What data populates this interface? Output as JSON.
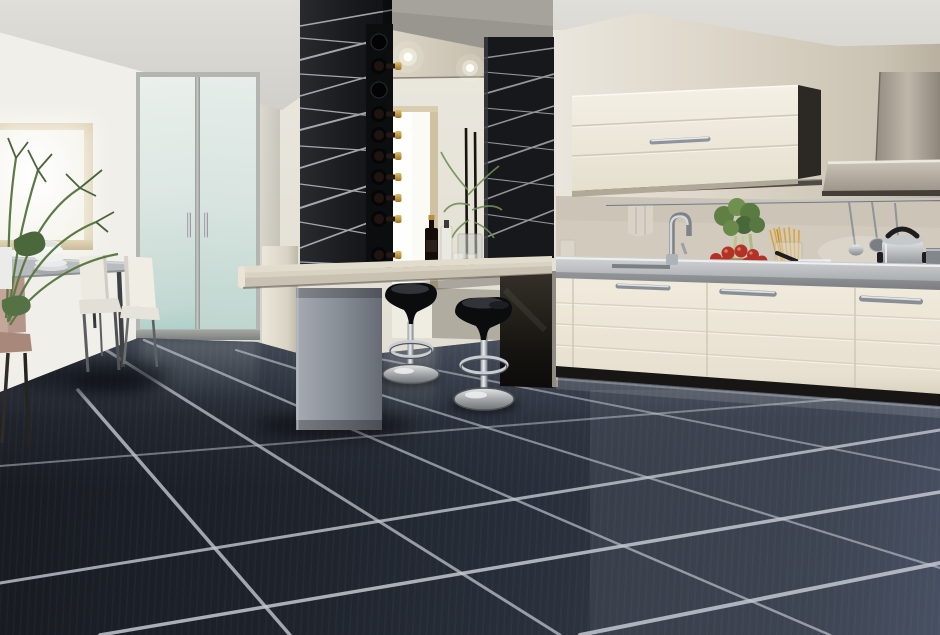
{
  "image": {
    "type": "photograph",
    "subject": "Modern open-plan kitchen interior with glossy dark diagonal floor tiles and silver grout",
    "width_px": 940,
    "height_px": 635
  },
  "palette": {
    "ceiling": "#d9d7d2",
    "left_wall": "#eeede7",
    "center_wall": "#e9e6dd",
    "right_wall_beige": "#d6cfc1",
    "floor_far": "#454c5a",
    "floor_near": "#14161c",
    "grout_line": "#c3c8d0",
    "panel_black": "#1b1c20",
    "panel_stripe": "#cfd3d8",
    "cabinet_cream": "#f0ebdf",
    "counter_steel": "#c3c6c7",
    "bar_counter": "#ddd7c8",
    "bar_pillar_gray": "#868c94",
    "stool_black": "#0b0c0e",
    "chrome": "#c9ced3",
    "door_glass": "#dde8e4",
    "door_glass_teal": "#bcd8d2",
    "window_glow": "#fbfbf7",
    "wood_frame": "#d8cbab",
    "plant_green": "#5d7c43",
    "wine_cap_gold": "#c9a24e",
    "tomato_red": "#b23228",
    "spaghetti_gold": "#d9a53f",
    "terracotta": "#b25c3c",
    "towel": "#d8d2c7",
    "chair_white": "#edeae2",
    "chair_salmon": "#b5968a",
    "table_gray": "#b9bcbe",
    "hood_steel": "#a89f93"
  },
  "objects": [
    {
      "name": "window-left",
      "label": "Daylight window with pale wood frame"
    },
    {
      "name": "houseplant",
      "label": "Leafy green houseplant in white vase"
    },
    {
      "name": "dining-table",
      "label": "Gray dining table"
    },
    {
      "name": "plate-stack",
      "label": "Stack of white bowls and plates"
    },
    {
      "name": "dining-chair-white",
      "label": "White dining chair",
      "count": 2
    },
    {
      "name": "dining-chair-salmon",
      "label": "Salmon dining chair",
      "count": 1
    },
    {
      "name": "frosted-double-doors",
      "label": "Frosted glass double doors with chrome pull handles"
    },
    {
      "name": "black-pillar",
      "label": "Black pillar with etched silver line pattern"
    },
    {
      "name": "wine-rack",
      "label": "Column wine rack",
      "bottle_count": 8,
      "empty_slots": 2
    },
    {
      "name": "canopy-shelf",
      "label": "Beige canopy shelf over bar",
      "spotlight_count": 2
    },
    {
      "name": "back-window",
      "label": "Tall bright window behind breakfast bar"
    },
    {
      "name": "stick-plant",
      "label": "Glass vase with tall dark stems and green sprays"
    },
    {
      "name": "wine-bottle",
      "label": "Dark wine bottle"
    },
    {
      "name": "clear-bottle",
      "label": "Clear glass bottle"
    },
    {
      "name": "tumblers",
      "label": "Drinking glasses",
      "count": 2
    },
    {
      "name": "cutting-board",
      "label": "Wooden cutting board"
    },
    {
      "name": "decor-panel",
      "label": "Black decor panel with silver lines"
    },
    {
      "name": "breakfast-bar",
      "label": "Floating breakfast bar counter on gray support"
    },
    {
      "name": "bar-stool",
      "label": "Glossy black pedestal bar stool with chrome base",
      "count": 2
    },
    {
      "name": "upper-cabinet",
      "label": "Cream horizontal wall cabinet with chrome handle"
    },
    {
      "name": "kitchen-towel",
      "label": "Hanging towel"
    },
    {
      "name": "utensil-rail",
      "label": "Steel utensil rail",
      "hanging_utensils": 3
    },
    {
      "name": "range-hood",
      "label": "Stainless chimney range hood"
    },
    {
      "name": "kitchen-faucet",
      "label": "Chrome arc faucet"
    },
    {
      "name": "sink",
      "label": "Stainless undermount sink"
    },
    {
      "name": "tomato-plate",
      "label": "Terracotta plate of ripe tomatoes"
    },
    {
      "name": "celery",
      "label": "Fresh leafy celery bunch"
    },
    {
      "name": "spaghetti-jar",
      "label": "Glass jar of spaghetti"
    },
    {
      "name": "saucepan",
      "label": "Steel saucepan with black handle"
    },
    {
      "name": "pressure-cooker",
      "label": "Stainless pressure cooker"
    },
    {
      "name": "hob",
      "label": "Built-in dark hob"
    },
    {
      "name": "base-cabinets",
      "label": "Cream base cabinets with chrome bar handles",
      "handle_count": 3
    },
    {
      "name": "floor",
      "label": "Large dark blue-black tiles laid diagonally with silver grout"
    }
  ]
}
